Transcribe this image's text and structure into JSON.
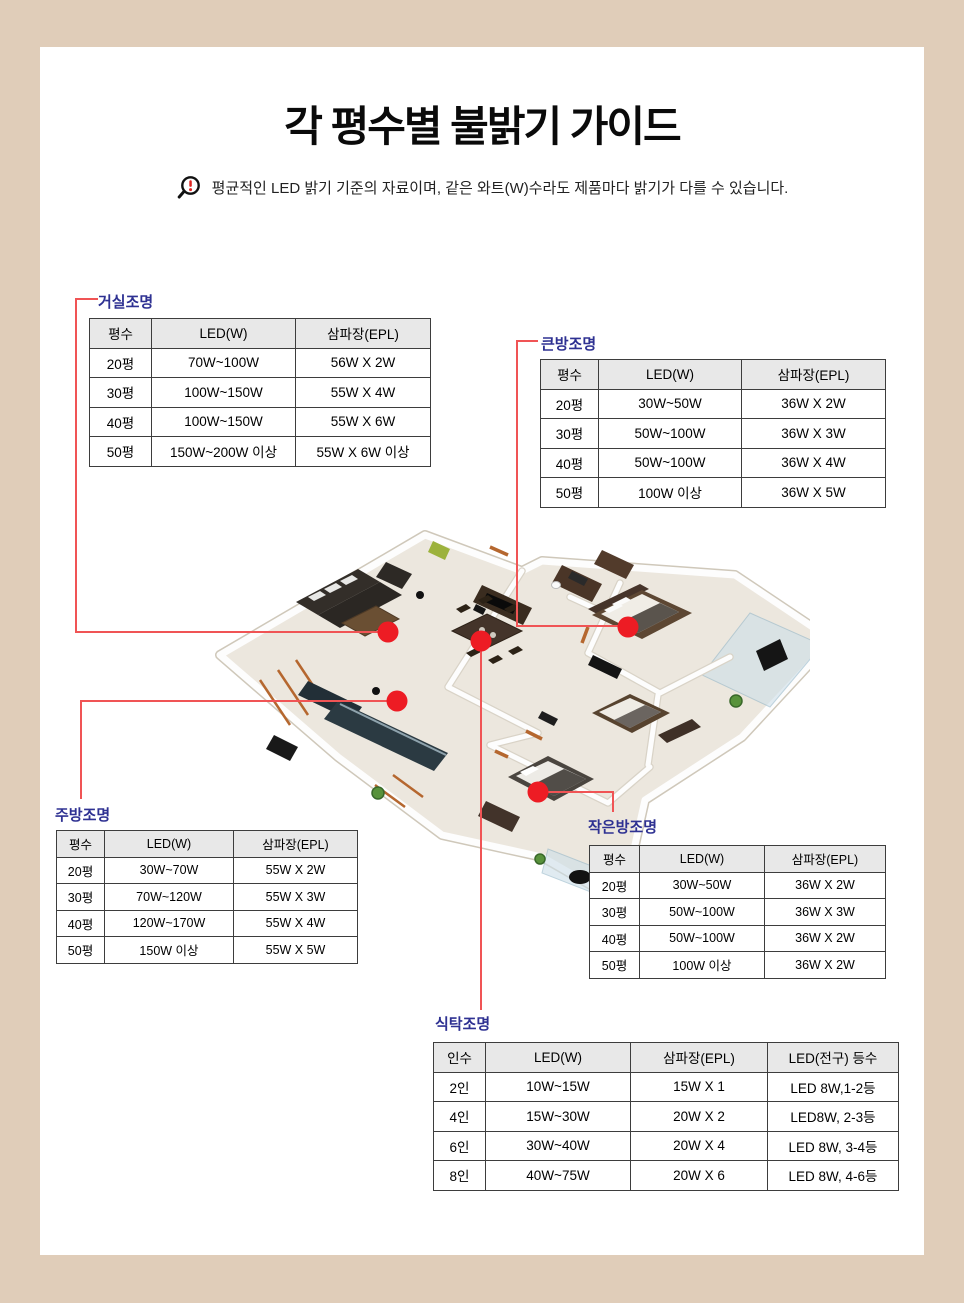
{
  "page": {
    "title": "각 평수별 불밝기 가이드",
    "notice": "평균적인 LED 밝기 기준의 자료이며, 같은 와트(W)수라도 제품마다 밝기가 다를 수 있습니다.",
    "notice_icon": "magnifier-exclamation-icon",
    "background_color": "#e0cdb9",
    "panel_color": "#ffffff"
  },
  "colors": {
    "label_blue": "#2e3192",
    "connector_red": "#f05455",
    "marker_dot_red": "#ed1c24",
    "table_border": "#3d3d3d",
    "table_header_gray": "#e8e8e8"
  },
  "tables": {
    "living": {
      "label": "거실조명",
      "headers": [
        "평수",
        "LED(W)",
        "삼파장(EPL)"
      ],
      "rows": [
        [
          "20평",
          "70W~100W",
          "56W X 2W"
        ],
        [
          "30평",
          "100W~150W",
          "55W X 4W"
        ],
        [
          "40평",
          "100W~150W",
          "55W X 6W"
        ],
        [
          "50평",
          "150W~200W 이상",
          "55W X 6W 이상"
        ]
      ]
    },
    "big_room": {
      "label": "큰방조명",
      "headers": [
        "평수",
        "LED(W)",
        "삼파장(EPL)"
      ],
      "rows": [
        [
          "20평",
          "30W~50W",
          "36W X 2W"
        ],
        [
          "30평",
          "50W~100W",
          "36W X 3W"
        ],
        [
          "40평",
          "50W~100W",
          "36W X 4W"
        ],
        [
          "50평",
          "100W 이상",
          "36W X 5W"
        ]
      ]
    },
    "kitchen": {
      "label": "주방조명",
      "headers": [
        "평수",
        "LED(W)",
        "삼파장(EPL)"
      ],
      "rows": [
        [
          "20평",
          "30W~70W",
          "55W X 2W"
        ],
        [
          "30평",
          "70W~120W",
          "55W X 3W"
        ],
        [
          "40평",
          "120W~170W",
          "55W X 4W"
        ],
        [
          "50평",
          "150W 이상",
          "55W X 5W"
        ]
      ]
    },
    "small_room": {
      "label": "작은방조명",
      "headers": [
        "평수",
        "LED(W)",
        "삼파장(EPL)"
      ],
      "rows": [
        [
          "20평",
          "30W~50W",
          "36W X 2W"
        ],
        [
          "30평",
          "50W~100W",
          "36W X 3W"
        ],
        [
          "40평",
          "50W~100W",
          "36W X 2W"
        ],
        [
          "50평",
          "100W 이상",
          "36W X 2W"
        ]
      ]
    },
    "dining": {
      "label": "식탁조명",
      "headers": [
        "인수",
        "LED(W)",
        "삼파장(EPL)",
        "LED(전구) 등수"
      ],
      "rows": [
        [
          "2인",
          "10W~15W",
          "15W X 1",
          "LED 8W,1-2등"
        ],
        [
          "4인",
          "15W~30W",
          "20W X 2",
          "LED8W, 2-3등"
        ],
        [
          "6인",
          "30W~40W",
          "20W X 4",
          "LED 8W, 3-4등"
        ],
        [
          "8인",
          "40W~75W",
          "20W X 6",
          "LED 8W, 4-6등"
        ]
      ]
    }
  }
}
